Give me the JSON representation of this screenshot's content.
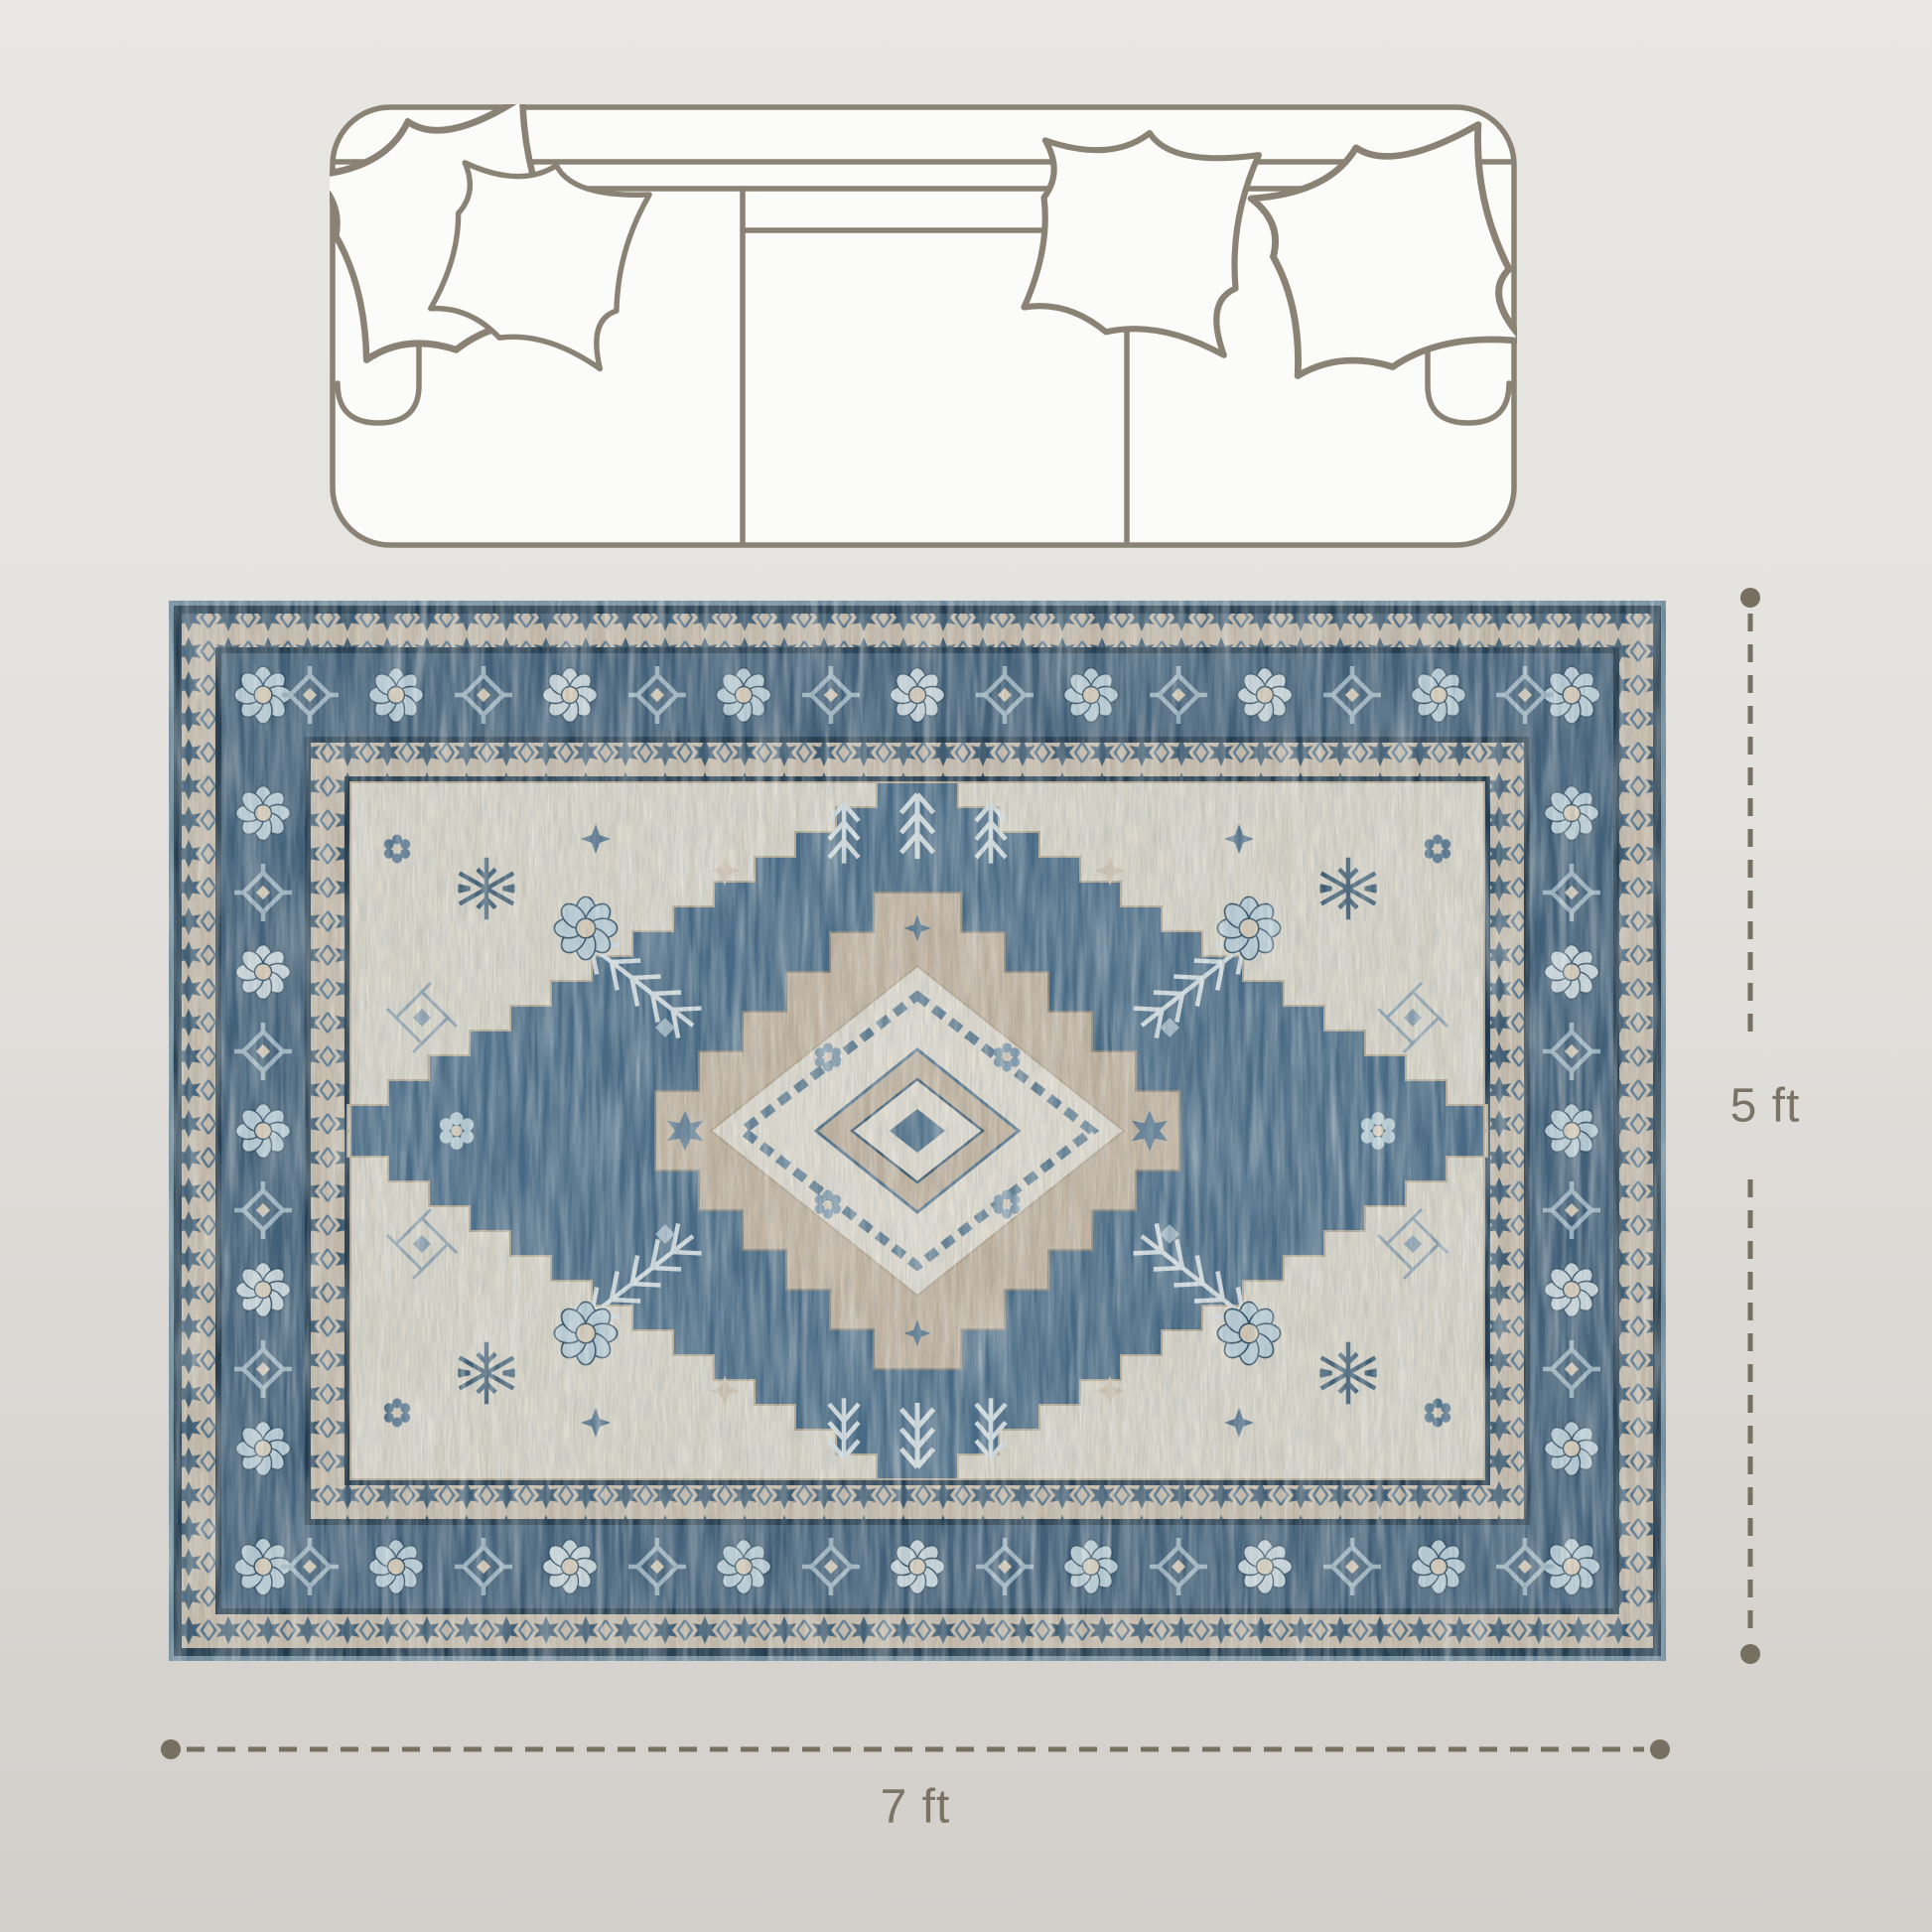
{
  "scene": {
    "background": {
      "top_color": "#e9e7e3",
      "bottom_color": "#d2cfcb"
    },
    "sofa": {
      "icon": "sofa-top-view-icon",
      "outline_color": "#8a8274",
      "fill_color": "#fbfbf9",
      "seat_count": 3,
      "pillow_count": 4
    },
    "rug": {
      "icon": "persian-rug-image",
      "colors": {
        "edge_teal": "#6e8c9e",
        "navy": "#22394b",
        "border_blue": "#3f5d76",
        "field_blue": "#466883",
        "guard_beige": "#c8bba9",
        "spandrel_ivory": "#d9d4c6",
        "medallion_tan": "#c2b29d",
        "medallion_ivory": "#e0dacd",
        "motif_pale_blue": "#b9cdd6"
      }
    },
    "dimensions": {
      "line_color": "#776f60",
      "text_color": "#7b7365",
      "height": {
        "label": "5 ft"
      },
      "width": {
        "label": "7 ft"
      }
    }
  }
}
